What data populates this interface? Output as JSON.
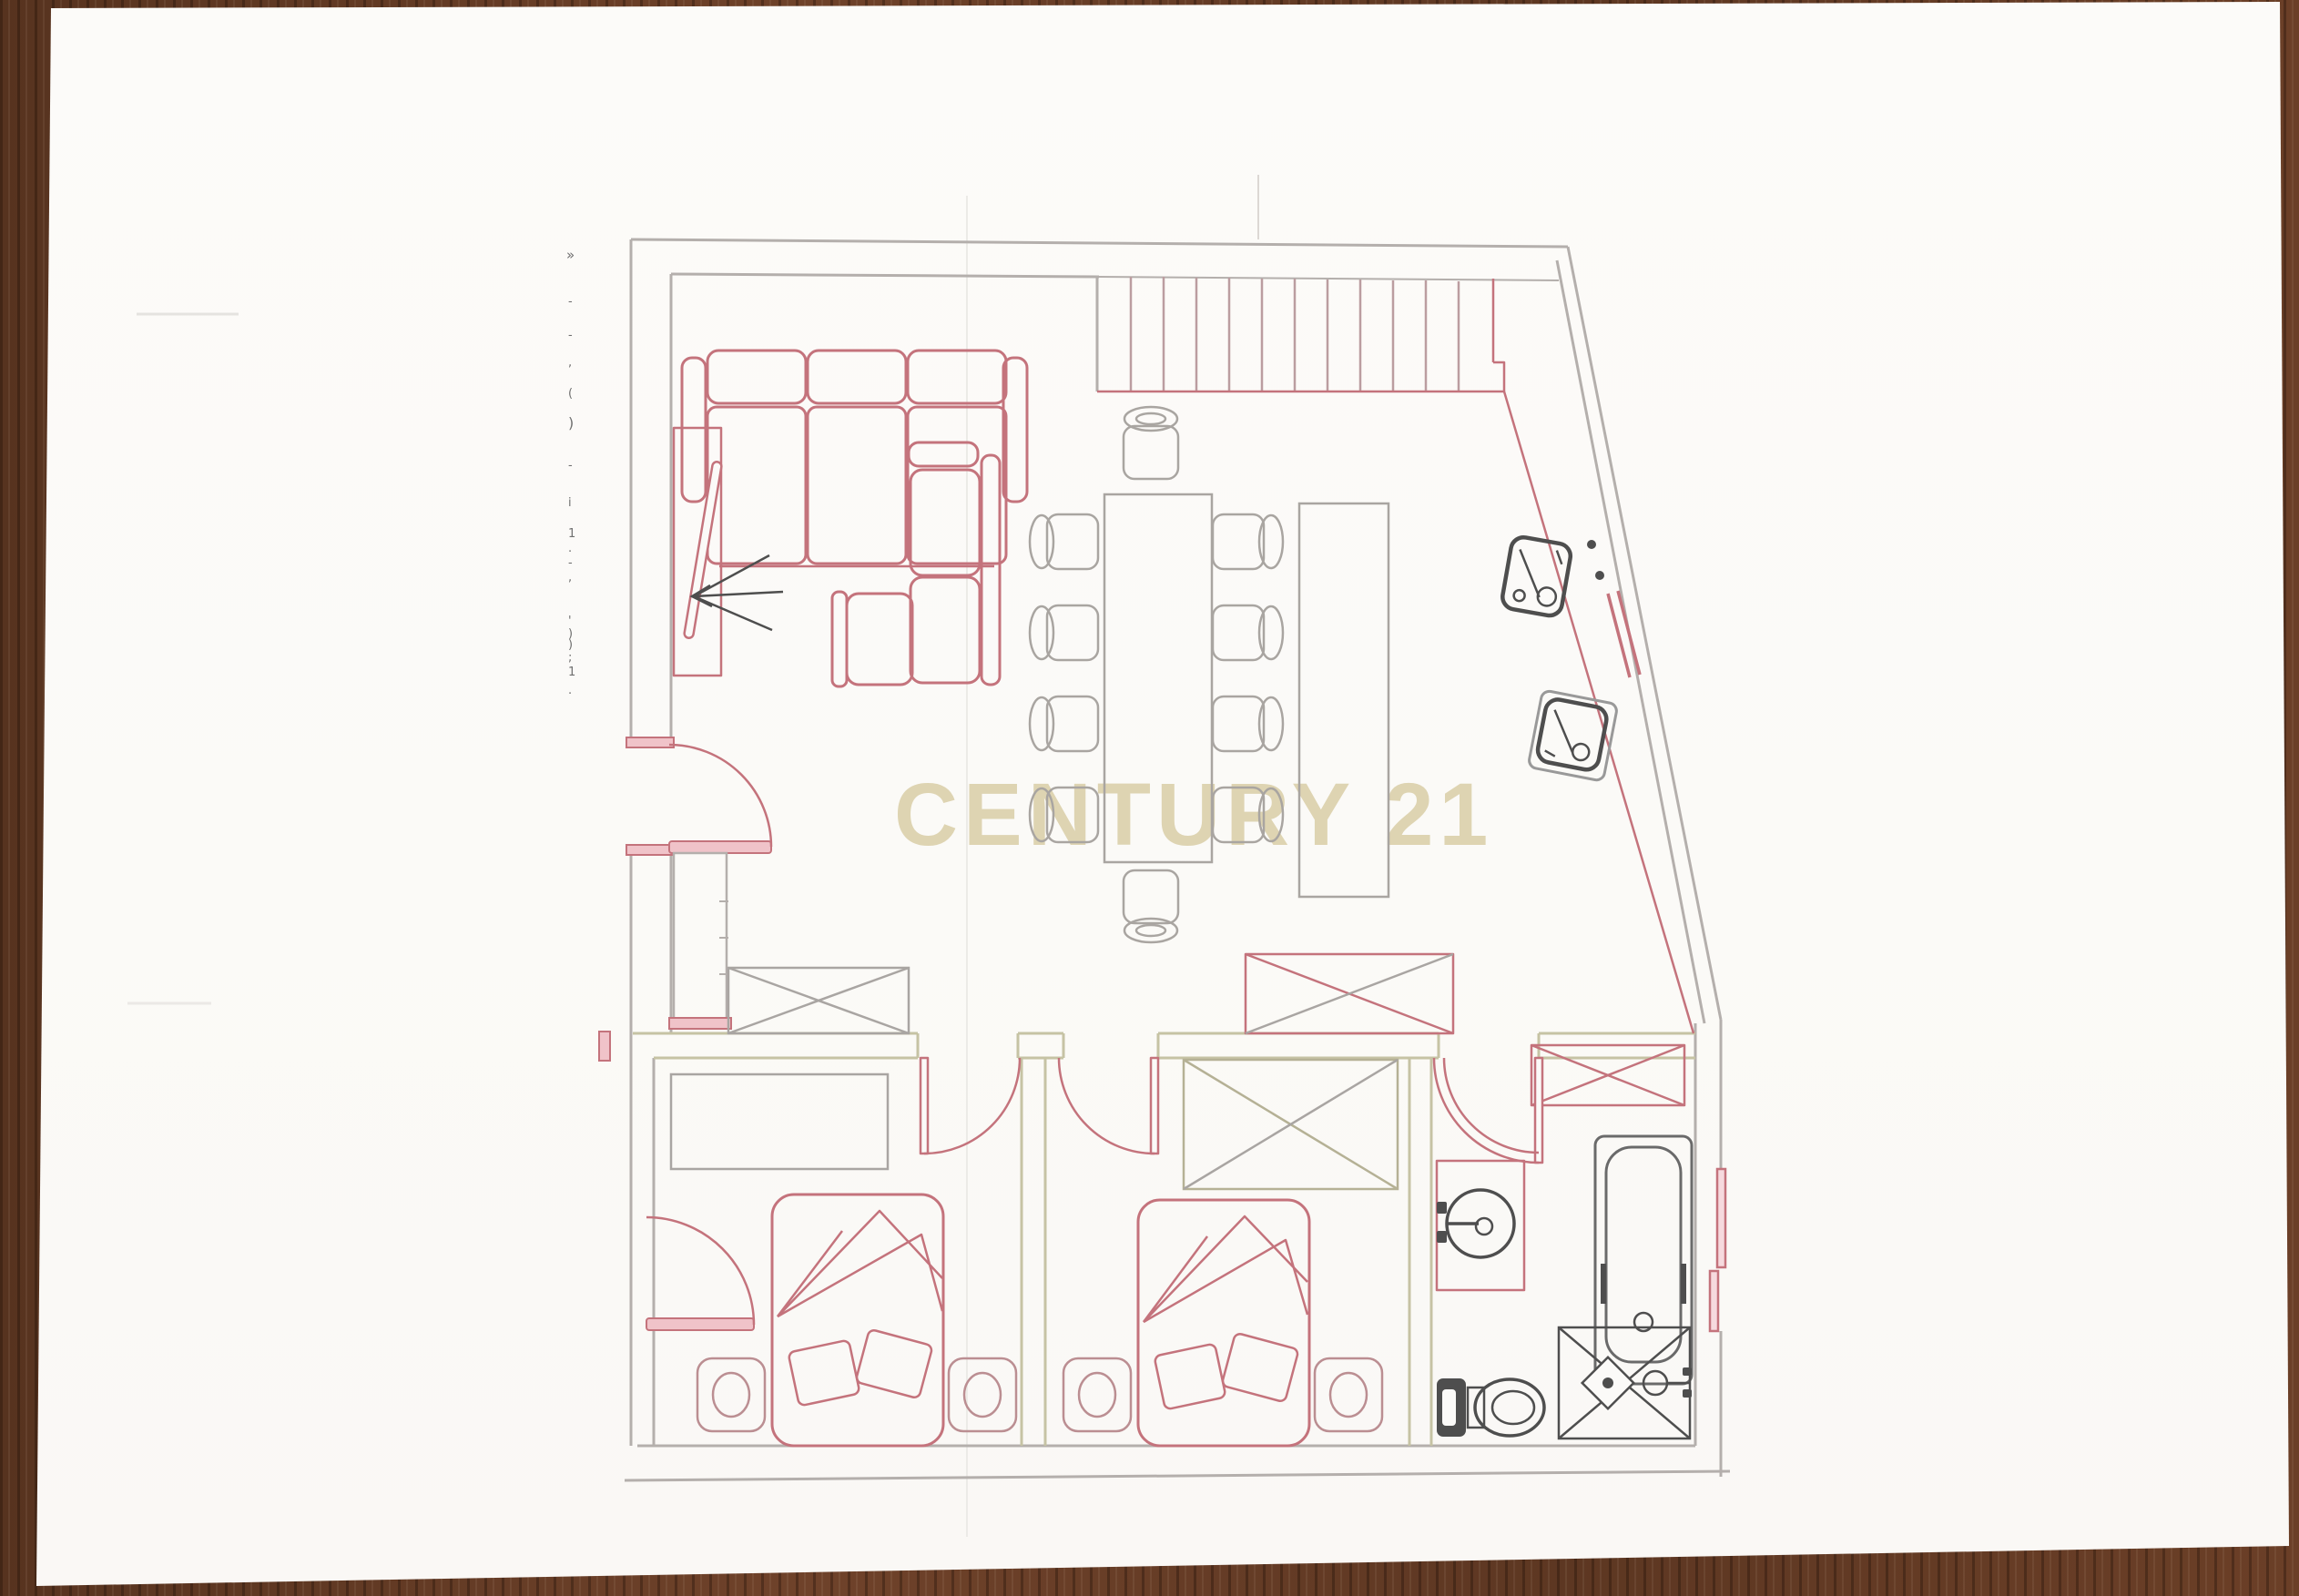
{
  "watermark": {
    "text": "CENTURY 21"
  },
  "colors": {
    "paper": "#fbfaf8",
    "wall_gray": "#b4afac",
    "wall_green": "#c6c3a4",
    "furniture_red": "#c4737c",
    "furniture_pink_fill": "#f0c3c9",
    "stair_riser": "#bb9da0",
    "fixture_dark": "#4e4e4e",
    "dining_gray": "#a9a5a1",
    "soft_red": "#bb8e92",
    "watermark": "#ded4b2",
    "margin_mark": "#6f6f6f",
    "crease": "#ecebe7",
    "smudge": "#e5e3e0"
  },
  "plan": {
    "symbols": [
      "three-seat-sofa",
      "corner-sofa",
      "tv-panel",
      "tv-direction-arrows",
      "dining-table-ten-chairs",
      "kitchen-island-counter",
      "staircase",
      "kitchen-sink",
      "kitchen-sink-2",
      "slanted-wall-window",
      "entry-door",
      "hall-closet",
      "hall-wardrobe",
      "bedroom-2-outer-wardrobe",
      "bedroom-2-wardrobe",
      "bathroom-cabinet",
      "bedroom-1-door",
      "bedroom-2-door",
      "bathroom-door",
      "bedroom-1-side-door",
      "bedroom-1-dresser",
      "double-bed-1",
      "double-bed-2",
      "nightstand-with-lamp",
      "vanity-sink",
      "bathtub",
      "toilet",
      "shower",
      "bathroom-window"
    ],
    "margin_marks": [
      "»",
      "-",
      "-",
      ",",
      "(",
      ")",
      "-",
      "i",
      "1",
      ".",
      "-",
      ",",
      "'",
      ")",
      ")",
      ";",
      "1",
      "."
    ]
  }
}
